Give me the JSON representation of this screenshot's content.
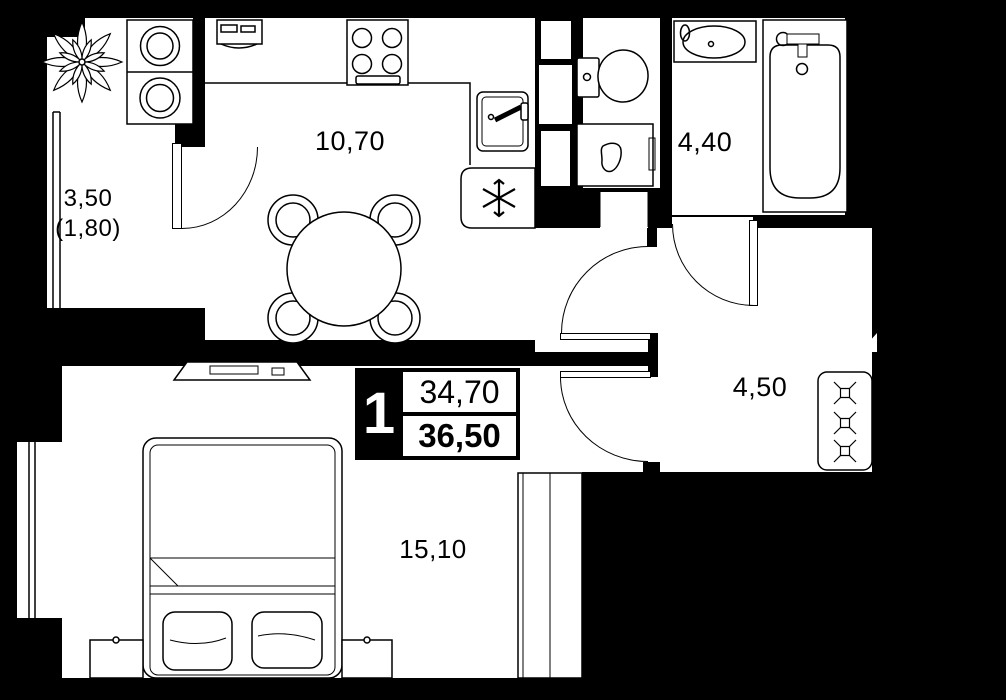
{
  "title": "apartment-floor-plan",
  "rooms": [
    {
      "name": "balcony",
      "label": "3,50",
      "label_secondary": "(1,80)"
    },
    {
      "name": "kitchen-living-room",
      "label": "10,70"
    },
    {
      "name": "bathroom",
      "label": "4,40"
    },
    {
      "name": "hallway",
      "label": "4,50"
    },
    {
      "name": "bedroom",
      "label": "15,10"
    }
  ],
  "info_block": {
    "rooms_count": "1",
    "area_primary": "34,70",
    "area_total": "36,50"
  },
  "icons": {
    "dishwasher_symbol": "six-ray asterisk",
    "coat_hook_symbol": "boxed X"
  },
  "colors": {
    "background": "#000000",
    "wall": "#000000",
    "floor": "#ffffff",
    "line": "#000000"
  }
}
